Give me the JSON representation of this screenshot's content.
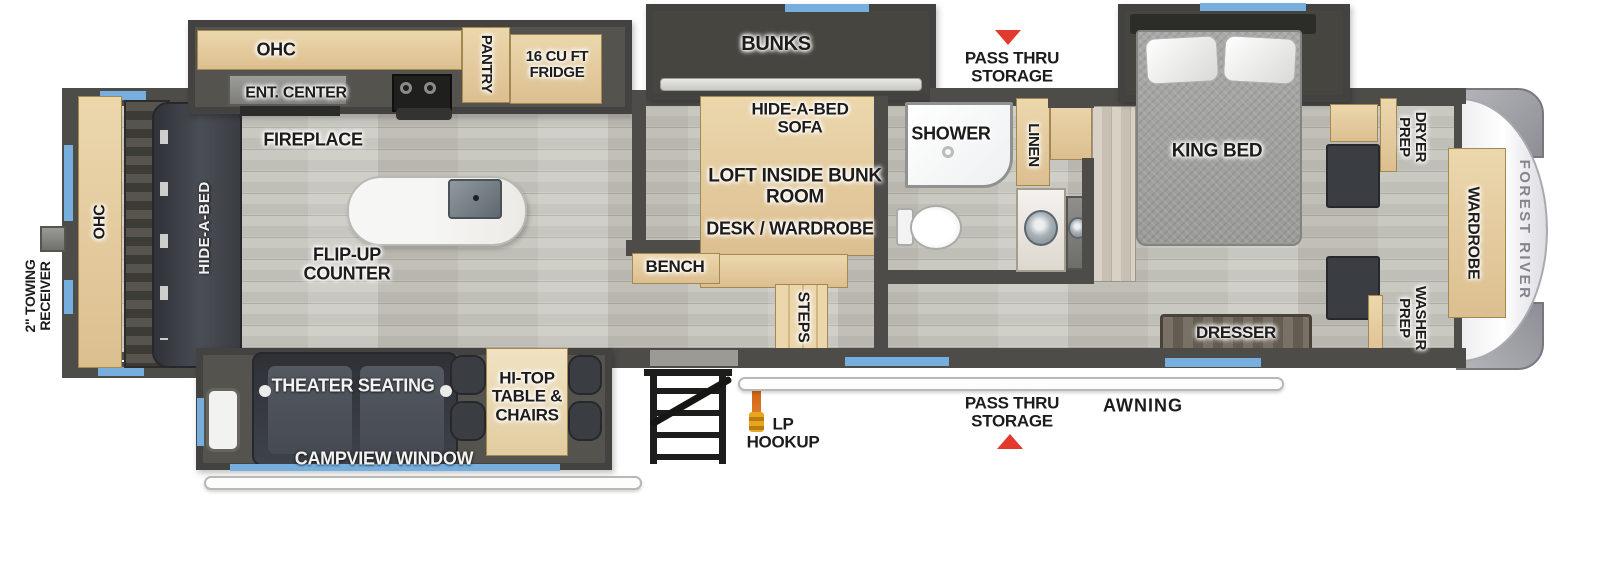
{
  "labels": {
    "ohc_kitchen": "OHC",
    "ent_center": "ENT. CENTER",
    "pantry": "PANTRY",
    "fridge": "16 CU FT FRIDGE",
    "fireplace": "FIREPLACE",
    "flip_up_counter": "FLIP-UP COUNTER",
    "bunks": "BUNKS",
    "pass_thru_top": "PASS THRU STORAGE",
    "hide_a_bed_sofa": "HIDE-A-BED SOFA",
    "loft": "LOFT INSIDE BUNK ROOM",
    "desk_wardrobe": "DESK / WARDROBE",
    "bench": "BENCH",
    "steps": "STEPS",
    "shower": "SHOWER",
    "linen": "LINEN",
    "king_bed": "KING BED",
    "dresser": "DRESSER",
    "dryer_prep": "DRYER PREP",
    "washer_prep": "WASHER PREP",
    "wardrobe": "WARDROBE",
    "brand": "FOREST RIVER",
    "ohc_rear": "OHC",
    "hide_a_bed": "HIDE-A-BED",
    "towing": "2\" TOWING RECEIVER",
    "theater": "THEATER SEATING",
    "hi_top": "HI-TOP TABLE & CHAIRS",
    "campview": "CAMPVIEW WINDOW",
    "lp_hookup": "LP HOOKUP",
    "pass_thru_bottom": "PASS THRU STORAGE",
    "awning": "AWNING"
  },
  "colors": {
    "wall": "#4d4c48",
    "floor": "#c2c1ba",
    "cabinet": "#e4cda1",
    "window_blue": "#76aede",
    "arrow_red": "#e23b2e",
    "front_cap": "#ffffff",
    "seating_dark": "#3a3d42"
  }
}
